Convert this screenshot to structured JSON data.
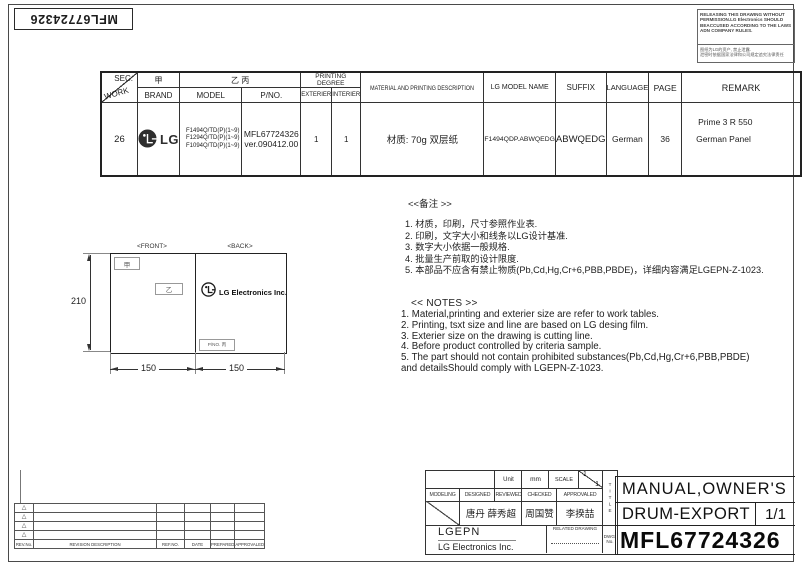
{
  "sheet": {
    "corner_label": "MFL67724326"
  },
  "warning": {
    "text_en": "RELEASING THIS DRAWING WITHOUT PERMISSION.LG Electronics SHOULD BEACCUSED ACCORDING TO THE LAWS ADN COMPANY RULES.",
    "text_cn": "图纸为LG的资产, 禁止泄露.\n泄密时依据国家法律和公司规定追究法律责任"
  },
  "spec_table": {
    "headers": {
      "sec": "SEC.",
      "work": "WORK",
      "brand_cn": "甲",
      "brand": "BRAND",
      "model_cn": "乙 丙",
      "model": "MODEL",
      "pno": "P/NO.",
      "printing_degree": "PRINTING DEGREE",
      "exterier": "EXTERIER",
      "interier": "INTERIER",
      "material": "MATERIAL AND PRINTING DESCRIPTION",
      "lg_model_name": "LG MODEL NAME",
      "suffix": "SUFFIX",
      "language": "LANGUAGE",
      "page": "PAGE",
      "remark": "REMARK"
    },
    "row": {
      "work": "26",
      "brand": "LG",
      "model_1": "F1494Q/TD(P)(1~9)",
      "model_2": "F1294Q/TD(P)(1~9)",
      "model_3": "F1094Q/TD(P)(1~9)",
      "pno_1": "MFL67724326",
      "pno_2": "ver.090412.00",
      "exterier": "1",
      "interier": "1",
      "material": "材质: 70g 双层纸",
      "lg_model_name": "F1494QDP.ABWQEDG",
      "suffix": "ABWQEDG",
      "language": "German",
      "page": "36",
      "remark_1": "Prime 3  R 550",
      "remark_2": "German Panel"
    }
  },
  "drawing": {
    "front_label": "<FRONT>",
    "back_label": "<BACK>",
    "front_mark_1": "甲",
    "front_mark_2": "乙",
    "back_logo_text": "LG Electronics Inc.",
    "back_pno_mark": "P/NO. 丙",
    "dim_height": "210",
    "dim_width_left": "150",
    "dim_width_right": "150"
  },
  "notes_cn": {
    "title": "<<备注 >>",
    "items": [
      "1. 材质，印刷，尺寸参照作业表.",
      "2. 印刷，文字大小和线条以LG设计基准.",
      "3. 数字大小依据一般规格.",
      "4. 批量生产前取的设计限度.",
      "5. 本部品不应含有禁止物质(Pb,Cd,Hg,Cr+6,PBB,PBDE)，详细内容满足LGEPN-Z-1023."
    ]
  },
  "notes_en": {
    "title": "<< NOTES >>",
    "items": [
      "1. Material,printing and exterier size are refer to work tables.",
      "2. Printing, tsxt  size and line are based on LG desing film.",
      "3. Exterier size on the drawing is cutting line.",
      "4. Before product controlled by criteria sample.",
      "5. The part should not contain prohibited substances(Pb,Cd,Hg,Cr+6,PBB,PBDE)\n    and detailsShould comply with LGEPN-Z-1023."
    ]
  },
  "title_block": {
    "unit_label": "Unit",
    "unit_value": "mm",
    "scale_label": "SCALE",
    "scale_num": "1",
    "scale_den": "1",
    "title_vertical": "TITLE",
    "col_modeling": "MODELING",
    "col_designed": "DESIGNED",
    "col_reviewed": "REVIEWED",
    "col_checked": "CHECKED",
    "col_approvaled": "APPROVALED",
    "designed_name": "唐丹 薛秀超",
    "checked_name": "周国赞",
    "approvaled_name": "李揆喆",
    "company_code": "LGEPN",
    "company_name": "LG Electronics Inc.",
    "related_drawing": "RELATED DRAWING",
    "dwg_no_label": "DWG. No.",
    "doc_title_1": "MANUAL,OWNER'S",
    "doc_title_2": "DRUM-EXPORT",
    "sheet_no": "1/1",
    "doc_number": "MFL67724326"
  },
  "revision_table": {
    "headers": [
      "REV.No.",
      "REVISION DESCRIPTION",
      "REF.NO.",
      "DATE",
      "PREPARED",
      "APPROVALED"
    ],
    "marker": "△"
  }
}
